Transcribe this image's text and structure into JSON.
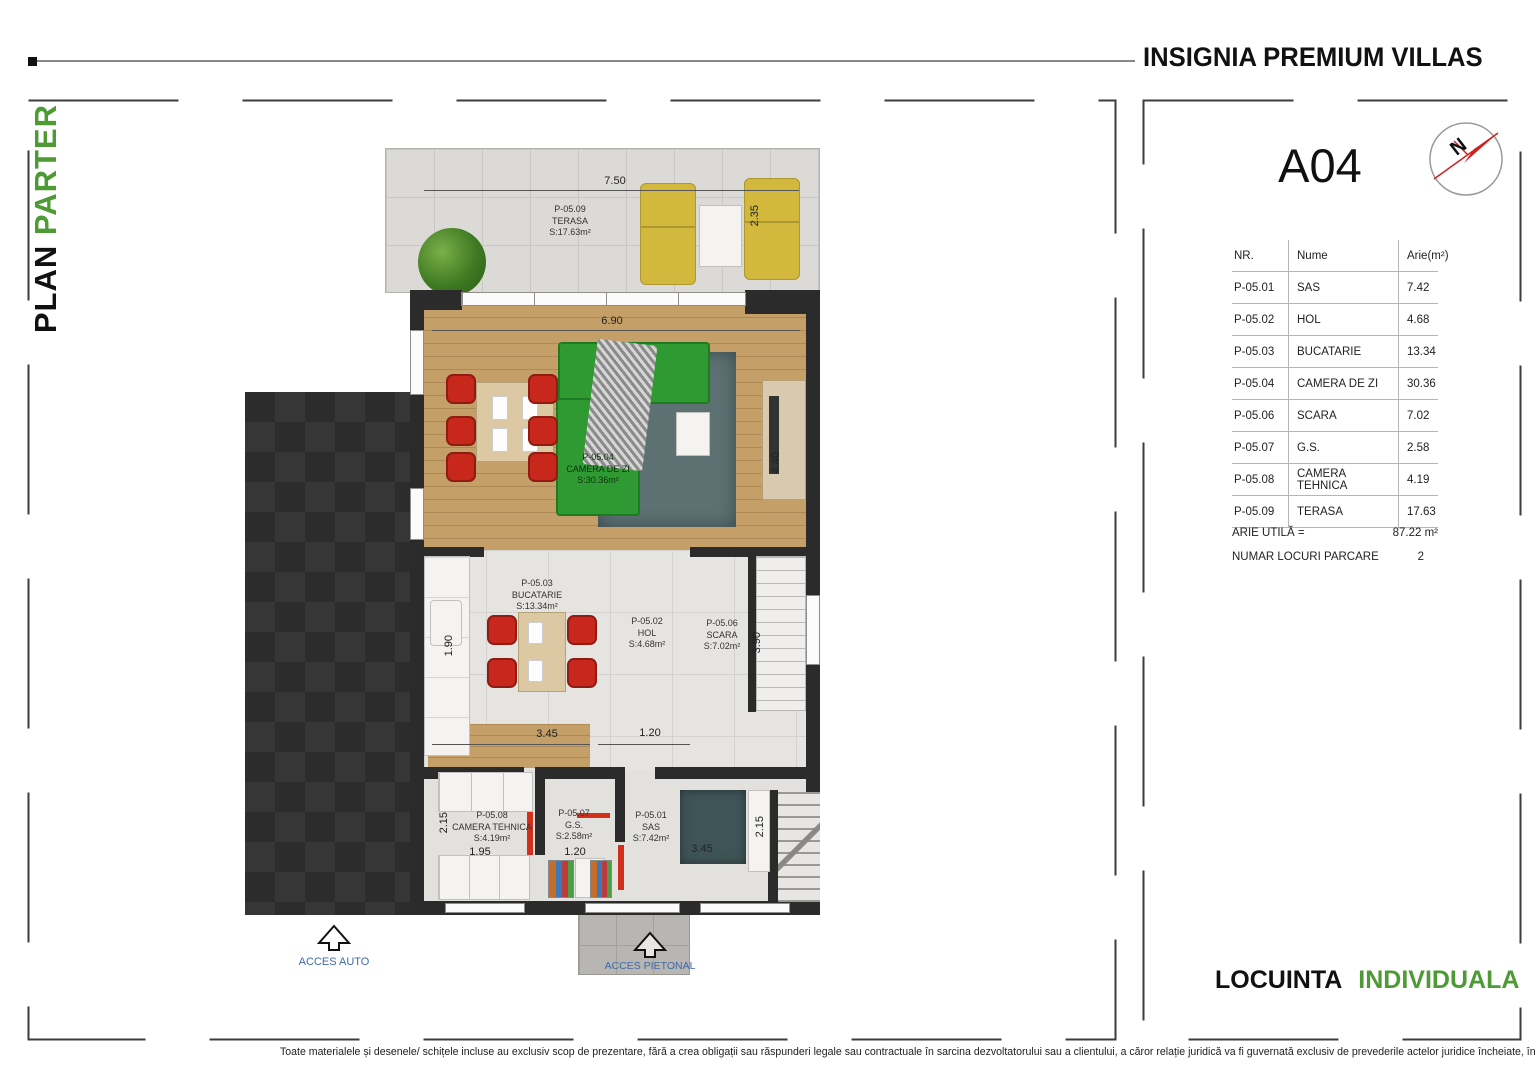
{
  "header": {
    "brand": "INSIGNIA PREMIUM VILLAS"
  },
  "side": {
    "plan_word": "PLAN",
    "floor_word": "PARTER"
  },
  "panel": {
    "unit": "A04",
    "compass_n": "N",
    "table": {
      "headers": [
        "NR.",
        "Nume",
        "Arie(m²)"
      ],
      "rows": [
        {
          "nr": "P-05.01",
          "name": "SAS",
          "area": "7.42"
        },
        {
          "nr": "P-05.02",
          "name": "HOL",
          "area": "4.68"
        },
        {
          "nr": "P-05.03",
          "name": "BUCATARIE",
          "area": "13.34"
        },
        {
          "nr": "P-05.04",
          "name": "CAMERA DE ZI",
          "area": "30.36"
        },
        {
          "nr": "P-05.06",
          "name": "SCARA",
          "area": "7.02"
        },
        {
          "nr": "P-05.07",
          "name": "G.S.",
          "area": "2.58"
        },
        {
          "nr": "P-05.08",
          "name": "CAMERA TEHNICA",
          "area": "4.19"
        },
        {
          "nr": "P-05.09",
          "name": "TERASA",
          "area": "17.63"
        }
      ]
    },
    "arie_label": "ARIE UTILĂ =",
    "arie_value": "87.22 m²",
    "parcare_label": "NUMAR LOCURI PARCARE",
    "parcare_value": "2",
    "footer_word1": "LOCUINTA",
    "footer_word2": "INDIVIDUALA"
  },
  "plan": {
    "rooms": {
      "terasa": {
        "id": "P-05.09",
        "name": "TERASA",
        "area": "S:17.63m²"
      },
      "camera_de_zi": {
        "id": "P-05.04",
        "name": "CAMERA DE ZI",
        "area": "S:30.36m²"
      },
      "bucatarie": {
        "id": "P-05.03",
        "name": "BUCATARIE",
        "area": "S:13.34m²"
      },
      "hol": {
        "id": "P-05.02",
        "name": "HOL",
        "area": "S:4.68m²"
      },
      "scara": {
        "id": "P-05.06",
        "name": "SCARA",
        "area": "S:7.02m²"
      },
      "camera_tehnica": {
        "id": "P-05.08",
        "name": "CAMERA TEHNICA",
        "area": "S:4.19m²"
      },
      "gs": {
        "id": "P-05.07",
        "name": "G.S.",
        "area": "S:2.58m²"
      },
      "sas": {
        "id": "P-05.01",
        "name": "SAS",
        "area": "S:7.42m²"
      }
    },
    "dims": {
      "terrace_width": "7.50",
      "terrace_depth": "2.35",
      "living_width": "6.90",
      "living_depth": "4.40",
      "kitchen_depth_left": "1.90",
      "stair_depth": "3.90",
      "kitchen_width": "3.45",
      "hall_width": "1.20",
      "tehnica_depth": "2.15",
      "tehnica_width": "1.95",
      "gs_width": "1.20",
      "sas_width": "3.45",
      "sas_depth": "2.15"
    },
    "access_auto": "ACCES AUTO",
    "access_pietonal": "ACCES PIETONAL"
  },
  "footer": {
    "disclaimer": "Toate materialele și desenele/ schițele incluse au exclusiv scop de prezentare, fără a crea obligații sau răspunderi legale sau contractuale în sarcina dezvoltatorului sau a clientului, a căror relație juridică va fi guvernată exclusiv de prevederile actelor juridice încheiate, în mod valabil, între părți."
  },
  "colors": {
    "accent_green": "#4e9b35",
    "access_blue": "#3f69a9",
    "wall_dark": "#2b2b2b",
    "chair_red": "#c8281c",
    "sofa_green": "#2f9a32",
    "lounger_yellow": "#d2b83c",
    "compass_red": "#d21f1f"
  }
}
